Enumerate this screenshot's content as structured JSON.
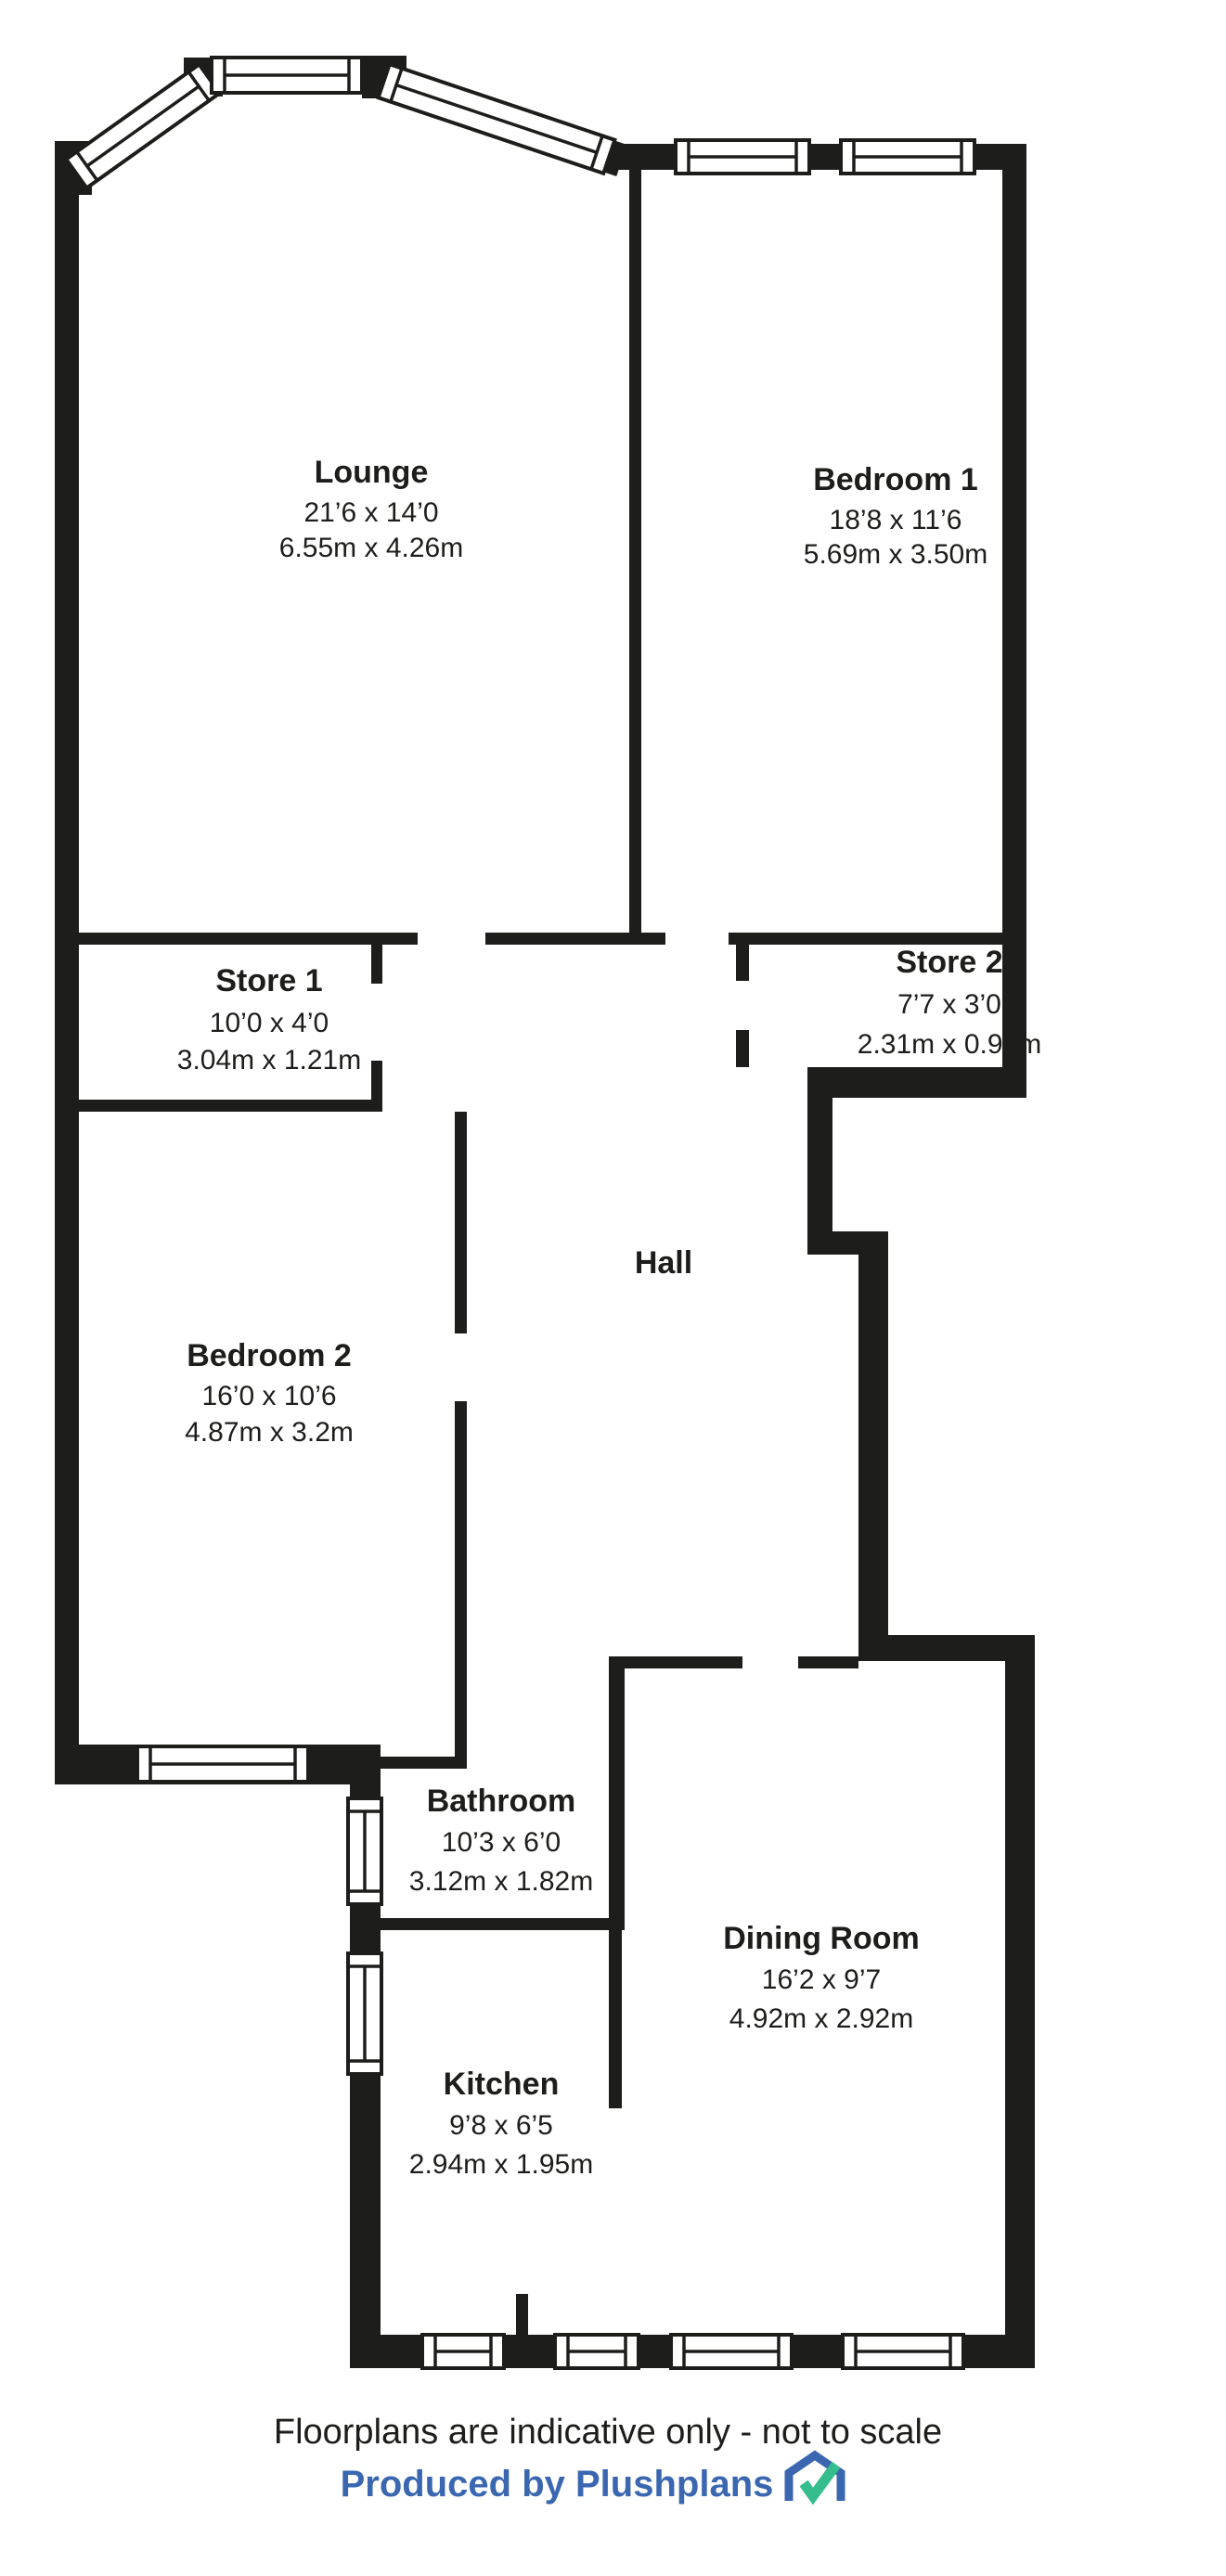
{
  "colors": {
    "wall": "#1d1d1b",
    "text": "#1d1d1b",
    "footer-blue": "#3a67b0",
    "logo-green": "#35bd8d"
  },
  "rooms": {
    "lounge": {
      "name": "Lounge",
      "imperial": "21’6 x 14’0",
      "metric": "6.55m x 4.26m"
    },
    "bedroom1": {
      "name": "Bedroom 1",
      "imperial": "18’8 x 11’6",
      "metric": "5.69m x 3.50m"
    },
    "store1": {
      "name": "Store 1",
      "imperial": "10’0 x 4’0",
      "metric": "3.04m x 1.21m"
    },
    "store2": {
      "name": "Store 2",
      "imperial": "7’7 x 3’0",
      "metric": "2.31m x 0.91m"
    },
    "hall": {
      "name": "Hall"
    },
    "bedroom2": {
      "name": "Bedroom 2",
      "imperial": "16’0 x 10’6",
      "metric": "4.87m x 3.2m"
    },
    "bathroom": {
      "name": "Bathroom",
      "imperial": "10’3 x 6’0",
      "metric": "3.12m x 1.82m"
    },
    "dining": {
      "name": "Dining Room",
      "imperial": "16’2 x 9’7",
      "metric": "4.92m x 2.92m"
    },
    "kitchen": {
      "name": "Kitchen",
      "imperial": "9’8 x 6’5",
      "metric": "2.94m x 1.95m"
    }
  },
  "footer": {
    "disclaimer": "Floorplans are indicative only - not to scale",
    "credit": "Produced by Plushplans"
  }
}
